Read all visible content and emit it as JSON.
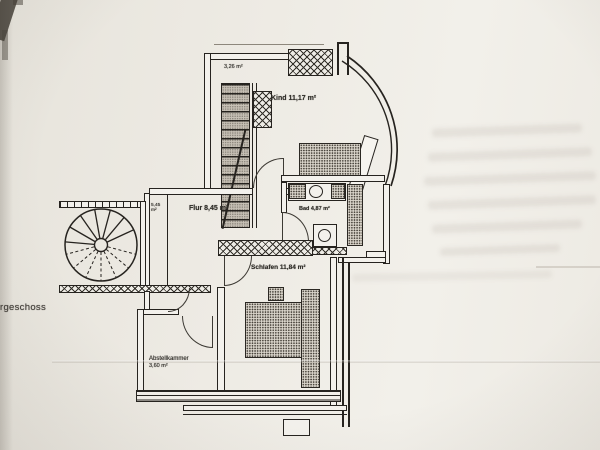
{
  "photo": {
    "paper_color": "#edeae3",
    "ink_color": "#26231f"
  },
  "floor_plan": {
    "storey_label": "rgeschoss",
    "room_labels": {
      "kind": "Kind 11,17 m²",
      "flur": "Flur 8,45 m²",
      "bad": "Bad 4,87 m²",
      "schlafen": "Schlafen 11,84 m²",
      "abstellkammer_name": "Abstellkammer",
      "abstellkammer_area": "3,60 m²"
    },
    "small_annotations": {
      "upper_left_area": "3,26 m²",
      "duct_area_line1": "5,45",
      "duct_area_line2": "m²"
    }
  }
}
